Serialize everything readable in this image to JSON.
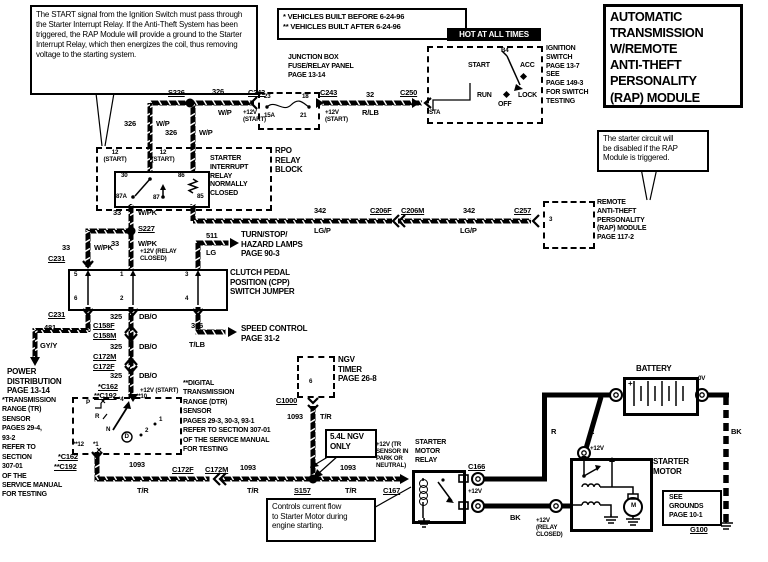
{
  "callouts": {
    "start": "The START signal from the Ignition Switch must pass through the Starter Interrupt Relay. If the Anti-Theft System has been triggered, the RAP Module will provide a ground to the Starter Interrupt Relay, which then energizes the coil, thus removing voltage to the starting system.",
    "rap": "The starter circuit will\nbe disabled if the RAP\nModule is triggered.",
    "controls": "Controls current flow\nto Starter Motor during\nengine starting."
  },
  "header": {
    "veh1": "* VEHICLES BUILT BEFORE 6-24-96",
    "veh2": "** VEHICLES BUILT AFTER 6-24-96",
    "title": "AUTOMATIC\nTRANSMISSION\nW/REMOTE\nANTI-THEFT\nPERSONALITY\n(RAP)  MODULE"
  },
  "ignition": {
    "hot": "HOT AT ALL TIMES",
    "b4": "B4",
    "start": "START",
    "acc": "ACC",
    "run": "RUN",
    "off": "OFF",
    "lock": "LOCK",
    "sta": "STA",
    "note": "IGNITION\nSWITCH\nPAGE 13-7\nSEE\nPAGE 149-3\nFOR SWITCH\nTESTING"
  },
  "junction": {
    "label": "JUNCTION BOX\nFUSE/RELAY PANEL\nPAGE 13-14",
    "f23": "23",
    "f18": "18",
    "f15a": "15A",
    "f21": "21"
  },
  "relay": {
    "rpo": "RPO\nRELAY\nBLOCK",
    "name": "STARTER\nINTERRUPT\nRELAY\nNORMALLY\nCLOSED",
    "p12a": "12\n(START)",
    "p12b": "12\n(START)",
    "p30": "30",
    "p86": "86",
    "p87a": "87A",
    "p87": "87",
    "p85": "85"
  },
  "cpp": {
    "label": "CLUTCH PEDAL\nPOSITION (CPP)\nSWITCH JUMPER",
    "p5": "5",
    "p1": "1",
    "p3": "3",
    "p6": "6",
    "p2": "2",
    "p4": "4"
  },
  "dest": {
    "turn": "TURN/STOP/\nHAZARD LAMPS\nPAGE 90-3",
    "speed": "SPEED CONTROL\nPAGE 31-2",
    "power": "POWER\nDISTRIBUTION\nPAGE 13-14"
  },
  "tr": {
    "note": "*TRANSMISSION\nRANGE (TR)\nSENSOR\nPAGES 29-4,\n93-2\nREFER TO\nSECTION\n307-01\nOF THE\nSERVICE MANUAL\nFOR TESTING",
    "p": "P",
    "r": "R",
    "n": "N",
    "d": "D",
    "g1": "1",
    "g2": "2",
    "t4": "*4",
    "t10": "**10",
    "t12": "**12",
    "t1": "*1"
  },
  "dtr": {
    "note": "**DIGITAL\nTRANSMISSION\nRANGE (DTR)\nSENSOR\nPAGES 29-3, 30-3, 93-1\nREFER TO SECTION 307-01\nOF THE SERVICE MANUAL\nFOR TESTING"
  },
  "ngv": {
    "label": "NGV\nTIMER\nPAGE 26-8",
    "p6": "6",
    "only": "5.4L NGV\nONLY"
  },
  "srelay": {
    "label": "STARTER\nMOTOR\nRELAY"
  },
  "rap": {
    "label": "REMOTE\nANTI-THEFT\nPERSONALITY\n(RAP)  MODULE\nPAGE 117-2",
    "p3": "3"
  },
  "batt": {
    "label": "BATTERY",
    "plus": "+"
  },
  "smotor": {
    "label": "STARTER\nMOTOR",
    "m": "M"
  },
  "grounds": {
    "box": "SEE\nGROUNDS\nPAGE 10-1",
    "g100": "G100"
  },
  "conn": {
    "s226": "S226",
    "s227": "S227",
    "s157": "S157",
    "c243a": "C243",
    "c243b": "C243",
    "c250": "C250",
    "c206f": "C206F",
    "c206m": "C206M",
    "c257": "C257",
    "c231a": "C231",
    "c231b": "C231",
    "c158f": "C158F",
    "c158m": "C158M",
    "c172m": "C172M",
    "c172f": "C172F",
    "c162a": "*C162",
    "c192a": "**C192",
    "c162b": "*C162",
    "c192b": "**C192",
    "c172f2": "C172F",
    "c172m2": "C172M",
    "c1000": "C1000",
    "c167": "C167",
    "c166": "C166",
    "g100": "G100"
  },
  "wire": {
    "w326a_n": "326",
    "w326a_c": "W/P",
    "w326b_n": "326",
    "w326b_c": "W/P",
    "w326c_n": "326",
    "w326c_c": "W/P",
    "w32_n": "32",
    "w32_c": "R/LB",
    "w342a_n": "342",
    "w342a_c": "LG/P",
    "w342b_n": "342",
    "w342b_c": "LG/P",
    "w33a_n": "33",
    "w33a_c": "W/PK",
    "w33b_n": "33",
    "w33b_c": "W/PK",
    "w33c_n": "33",
    "w33c_c": "W/PK",
    "w511_n": "511",
    "w511_c": "LG",
    "w325a_n": "325",
    "w325a_c": "DB/O",
    "w325b_n": "325",
    "w325b_c": "DB/O",
    "w325c_n": "325",
    "w325c_c": "DB/O",
    "w481_n": "481",
    "w481_c": "GY/Y",
    "w306_n": "306",
    "w306_c": "T/LB",
    "w1093a_n": "1093",
    "w1093a_c": "T/R",
    "w1093b_n": "1093",
    "w1093b_c": "T/R",
    "w1093c_n": "1093",
    "w1093c_c": "T/R",
    "w1093d_n": "1093",
    "w1093d_c": "T/R",
    "wr1": "R",
    "wr2": "R",
    "wbk1": "BK",
    "wbk2": "BK"
  },
  "volt": {
    "v_start_a": "+12V\n(START)",
    "v_start_b": "+12V\n(START)",
    "v_start_c": "+12V (START)",
    "v_relay_a": "+12V (RELAY\nCLOSED)",
    "v_relay_b": "+12V\n(RELAY\nCLOSED)",
    "v_tr": "+12V (TR\nSENSOR IN\nPARK OR\nNEUTRAL)",
    "v12_c166": "+12V",
    "v12_sm": "+12V",
    "v0": "0V"
  }
}
